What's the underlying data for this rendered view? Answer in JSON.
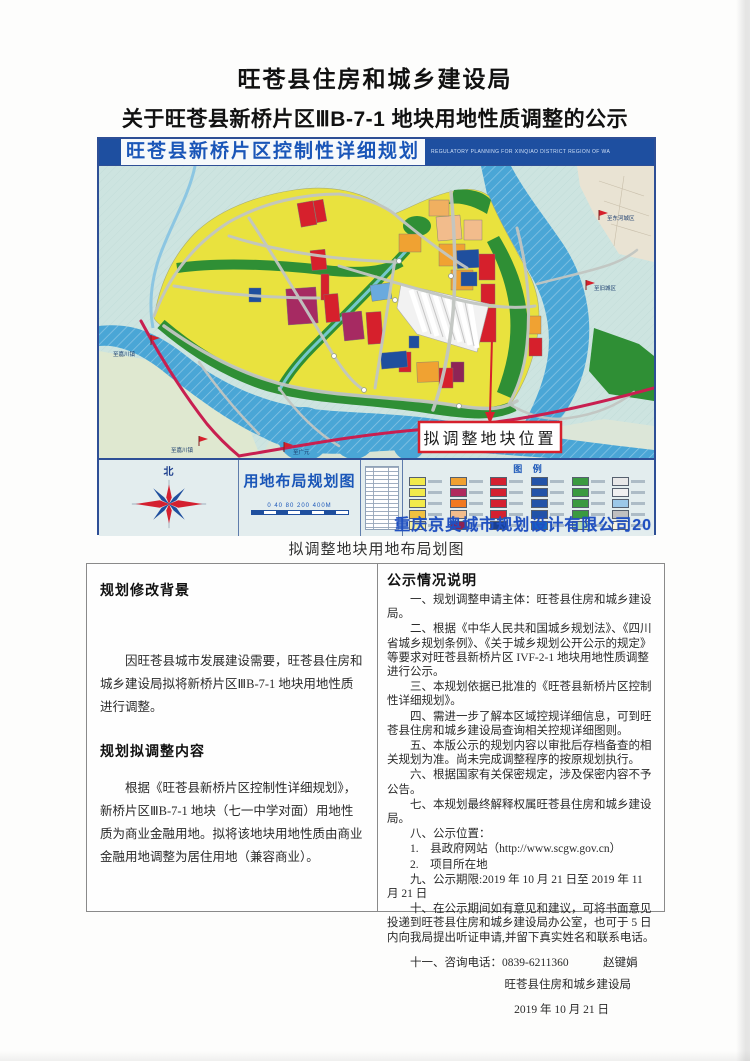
{
  "page": {
    "title_line1": "旺苍县住房和城乡建设局",
    "title_line2": "关于旺苍县新桥片区ⅢB-7-1 地块用地性质调整的公示",
    "caption": "拟调整地块用地布局划图"
  },
  "map": {
    "header": {
      "title": "旺苍县新桥片区控制性详细规划",
      "subtitle_en": "REGULATORY PLANNING FOR XINQIAO DISTRICT REGION OF WA"
    },
    "callout_label": "拟调整地块位置",
    "markers": [
      {
        "label": "至东河城区"
      },
      {
        "label": "至旧城区"
      },
      {
        "label": "至嘉川镇"
      },
      {
        "label": "至嘉川镇"
      },
      {
        "label": "至广元"
      }
    ],
    "footer": {
      "north_label": "北",
      "plan_title": "用地布局规划图",
      "scale_text": "0 40 80   200     400M",
      "legend_title": "图 例",
      "company": "重庆京奥城市规划设计有限公司20"
    },
    "colors": {
      "water_blue": "#4aa6d6",
      "residential_yellow": "#e9e23e",
      "commercial_red": "#d6202c",
      "green_space": "#2f8f35",
      "admin_blue": "#1f4f9e",
      "mixed_magenta": "#a62a62",
      "industry_orange": "#f0a232",
      "railway_crimson": "#c81f50",
      "frame_blue": "#1e4fa0",
      "callout_border_red": "#d6202c"
    },
    "legend_colors": [
      "#f2ea4a",
      "#f0a030",
      "#d42030",
      "#2253a8",
      "#3a9a40",
      "#e8e8e8",
      "#f2ea4a",
      "#b02a5e",
      "#d42030",
      "#2253a8",
      "#3a9a40",
      "#f0f0f0",
      "#f2ea4a",
      "#f07820",
      "#d42030",
      "#2253a8",
      "#3a9a40",
      "#9cc8e8",
      "#f0c040",
      "#f2bc8c",
      "#d42030",
      "#2253a8",
      "#3a9a40",
      "#c0c0c0",
      "#f6f0a0",
      "#8b2252",
      "#1a3f8f",
      "#1565c8",
      "#b8e0b0",
      "#f8f4e0"
    ]
  },
  "panel": {
    "left": {
      "heading1": "规划修改背景",
      "para1": "因旺苍县城市发展建设需要，旺苍县住房和城乡建设局拟将新桥片区ⅢB-7-1 地块用地性质进行调整。",
      "heading2": "规划拟调整内容",
      "para2": "根据《旺苍县新桥片区控制性详细规划》，新桥片区ⅢB-7-1 地块（七一中学对面）用地性质为商业金融用地。拟将该地块用地性质由商业金融用地调整为居住用地（兼容商业）。"
    },
    "right": {
      "heading": "公示情况说明",
      "items": [
        "一、规划调整申请主体：旺苍县住房和城乡建设局。",
        "二、根据《中华人民共和国城乡规划法》、《四川省城乡规划条例》、《关于城乡规划公开公示的规定》等要求对旺苍县新桥片区 IVF-2-1 地块用地性质调整进行公示。",
        "三、本规划依据已批准的《旺苍县新桥片区控制性详细规划》。",
        "四、需进一步了解本区域控规详细信息，可到旺苍县住房和城乡建设局查询相关控规详细图则。",
        "五、本版公示的规划内容以审批后存档备查的相关规划为准。尚未完成调整程序的按原规划执行。",
        "六、根据国家有关保密规定，涉及保密内容不予公告。",
        "七、本规划最终解释权属旺苍县住房和城乡建设局。",
        "八、公示位置：",
        "1.　县政府网站（http://www.scgw.gov.cn）",
        "2.　项目所在地",
        "九、公示期限:2019 年 10 月 21 日至 2019 年 11 月 21 日",
        "十、在公示期间如有意见和建议，可将书面意见投递到旺苍县住房和城乡建设局办公室，也可于 5 日内向我局提出听证申请,并留下真实姓名和联系电话。",
        "十一、咨询电话：0839-6211360　　　赵键娟"
      ],
      "signature": "旺苍县住房和城乡建设局",
      "date": "2019 年 10 月 21 日"
    }
  }
}
